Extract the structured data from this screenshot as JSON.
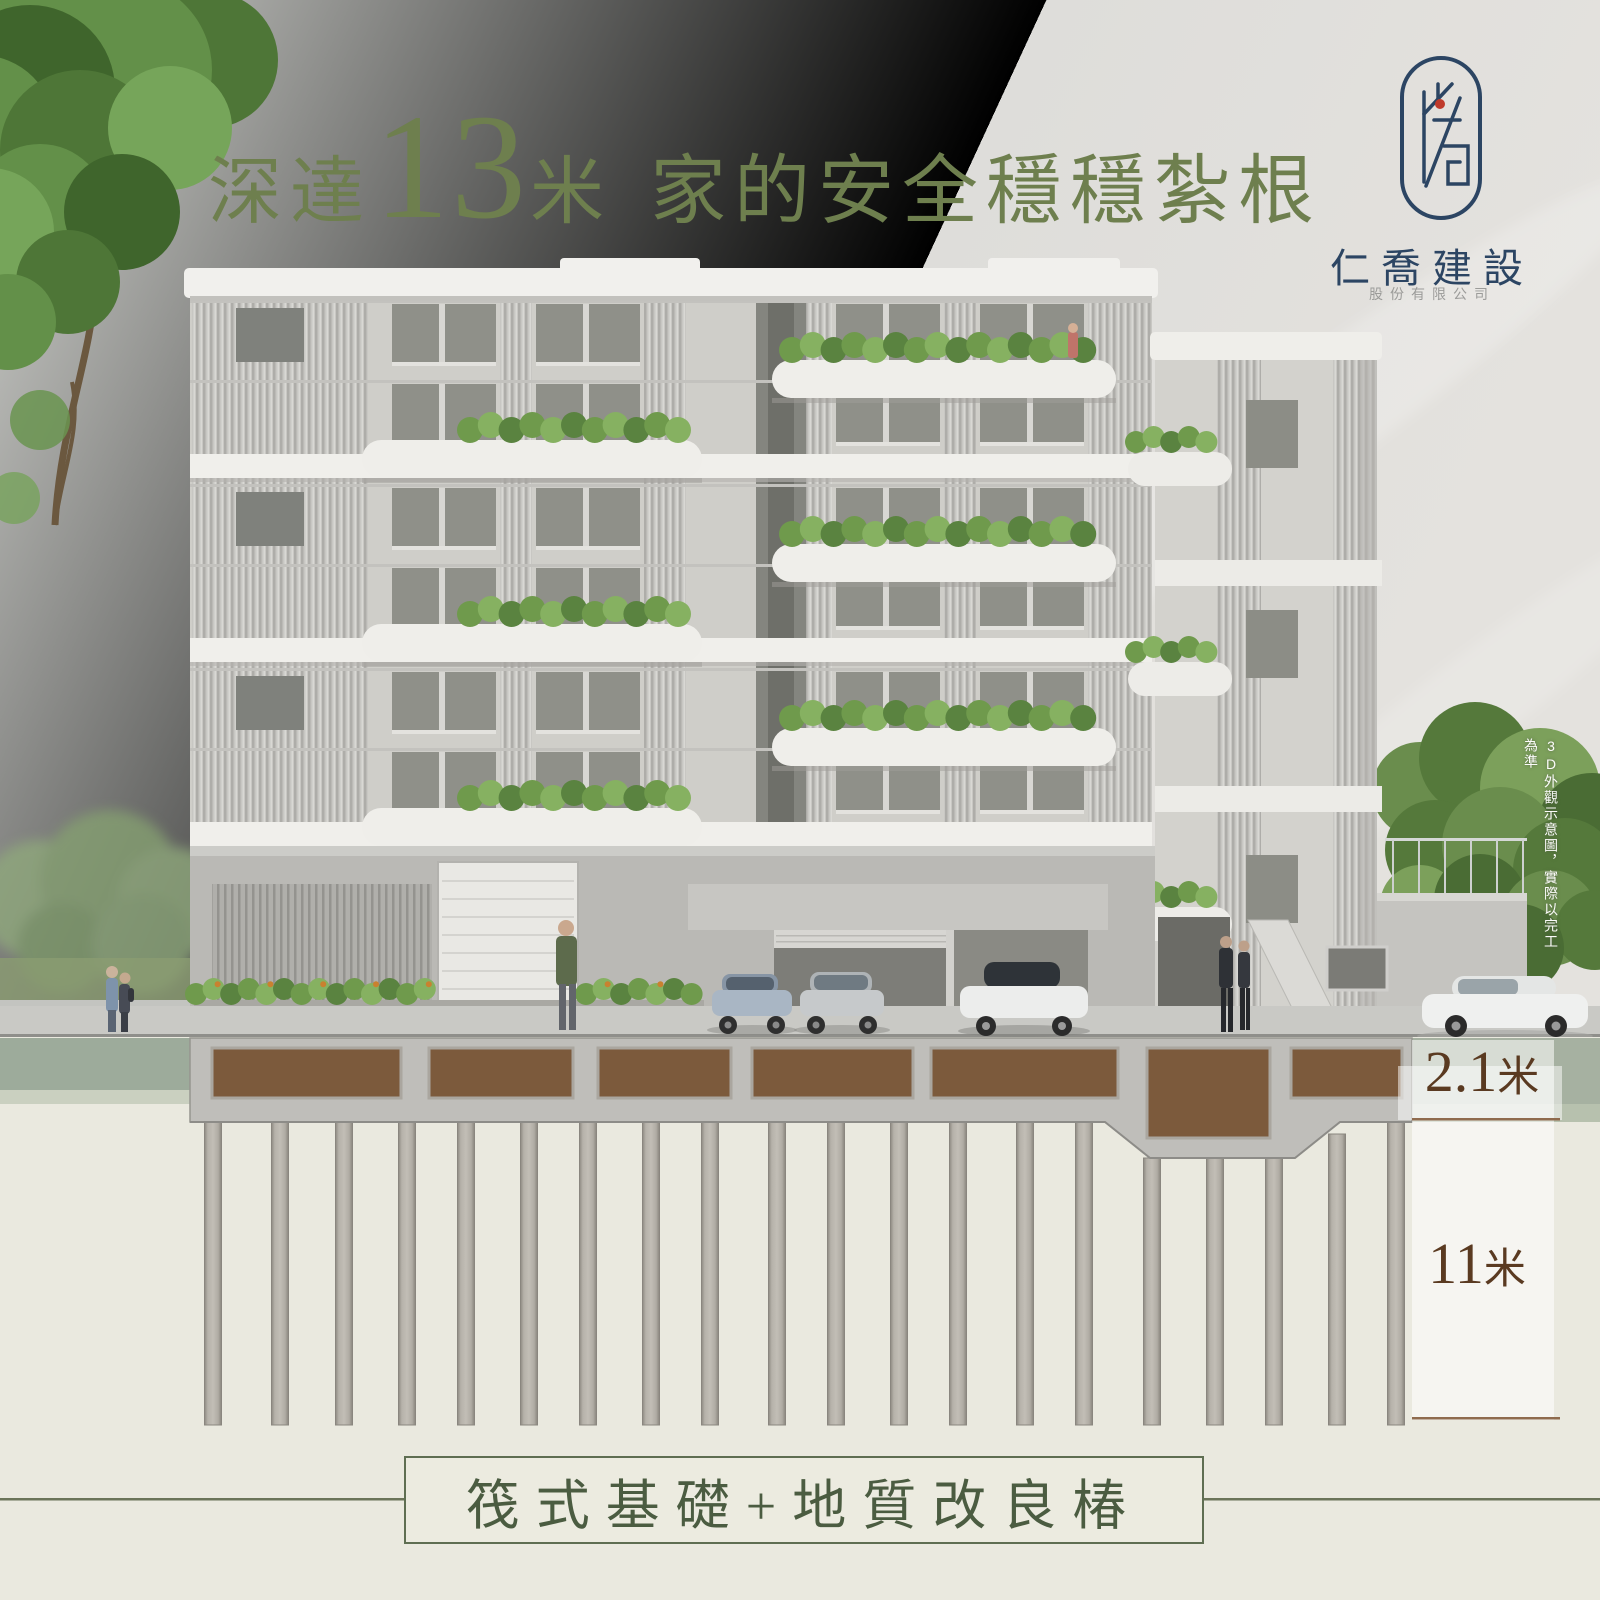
{
  "page": {
    "width": 1600,
    "height": 1600
  },
  "title": {
    "prefix": "深達",
    "number": "13",
    "unit": "米",
    "suffix": "家的安全穩穩紮根"
  },
  "logo": {
    "company_name": "仁喬建設",
    "company_subtitle": "股份有限公司"
  },
  "disclaimer": {
    "vertical_text": "3D外觀示意圖，實際以完工為準"
  },
  "measurements": {
    "raft_depth": {
      "value": "2.1",
      "unit": "米"
    },
    "pile_depth": {
      "value": "11",
      "unit": "米"
    }
  },
  "caption": {
    "label": "筏式基礎+地質改良椿"
  },
  "colors": {
    "title_green": "#6e7f4e",
    "caption_green": "#4b5c41",
    "logo_navy": "#2c4563",
    "logo_red": "#bf3a2b",
    "measure_brown": "#5a3a21",
    "soil_brown": "#7c5a3c",
    "concrete": "#bfbeba",
    "cream_ground": "#eae9df",
    "sage_band": "#9dab9b"
  },
  "foundation": {
    "pile_count": 20,
    "pile_bottom": 1425,
    "piles": [
      {
        "x": 213,
        "top": 1122
      },
      {
        "x": 280,
        "top": 1122
      },
      {
        "x": 344,
        "top": 1122
      },
      {
        "x": 407,
        "top": 1122
      },
      {
        "x": 466,
        "top": 1122
      },
      {
        "x": 529,
        "top": 1122
      },
      {
        "x": 588,
        "top": 1122
      },
      {
        "x": 651,
        "top": 1122
      },
      {
        "x": 710,
        "top": 1122
      },
      {
        "x": 777,
        "top": 1122
      },
      {
        "x": 836,
        "top": 1122
      },
      {
        "x": 899,
        "top": 1122
      },
      {
        "x": 958,
        "top": 1122
      },
      {
        "x": 1025,
        "top": 1122
      },
      {
        "x": 1084,
        "top": 1122
      },
      {
        "x": 1152,
        "top": 1158
      },
      {
        "x": 1215,
        "top": 1158
      },
      {
        "x": 1274,
        "top": 1158
      },
      {
        "x": 1337,
        "top": 1134
      },
      {
        "x": 1396,
        "top": 1122
      }
    ],
    "soil_boxes": [
      {
        "x": 212,
        "w": 189,
        "h": 50
      },
      {
        "x": 429,
        "w": 144,
        "h": 50
      },
      {
        "x": 598,
        "w": 133,
        "h": 50
      },
      {
        "x": 752,
        "w": 161,
        "h": 50
      },
      {
        "x": 931,
        "w": 187,
        "h": 50
      },
      {
        "x": 1147,
        "w": 123,
        "h": 90
      },
      {
        "x": 1291,
        "w": 111,
        "h": 50
      }
    ]
  }
}
